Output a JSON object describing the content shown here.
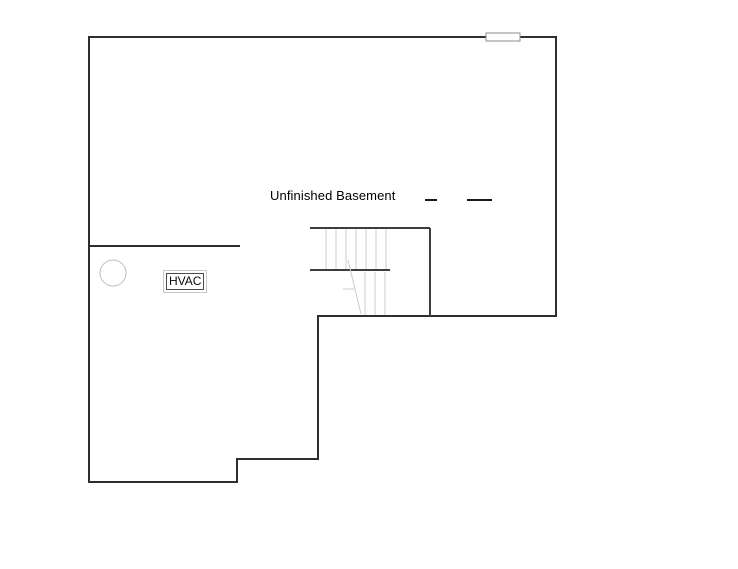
{
  "plan": {
    "room_label": "Unfinished Basement",
    "hvac_label": "HVAC",
    "colors": {
      "wall": "#2e2e2e",
      "stair_wall": "#3d3d3d",
      "tread": "#cccccc",
      "fixture": "#bdbdbd",
      "window_border": "#8c8c8c",
      "dash": "#1a1a1a",
      "text": "#000000"
    }
  }
}
